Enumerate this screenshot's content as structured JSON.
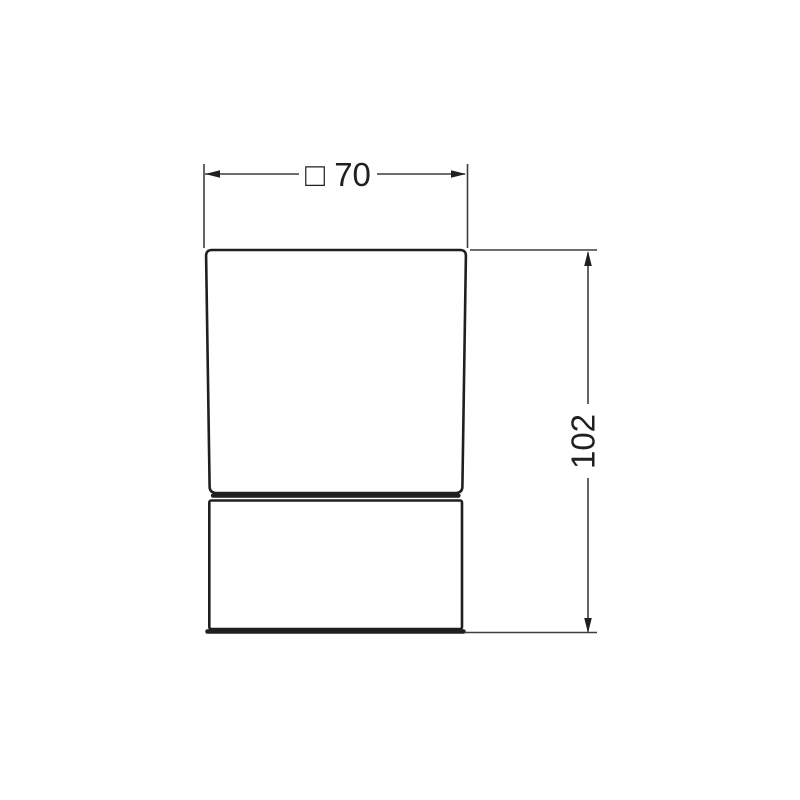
{
  "drawing": {
    "dim_width": {
      "label": "□ 70",
      "value": 70
    },
    "dim_height": {
      "label": "102",
      "value": 102
    },
    "colors": {
      "background": "#ffffff",
      "object_line": "#1f1f1f",
      "dimension_line": "#3d3d3d",
      "text": "#202020"
    }
  }
}
